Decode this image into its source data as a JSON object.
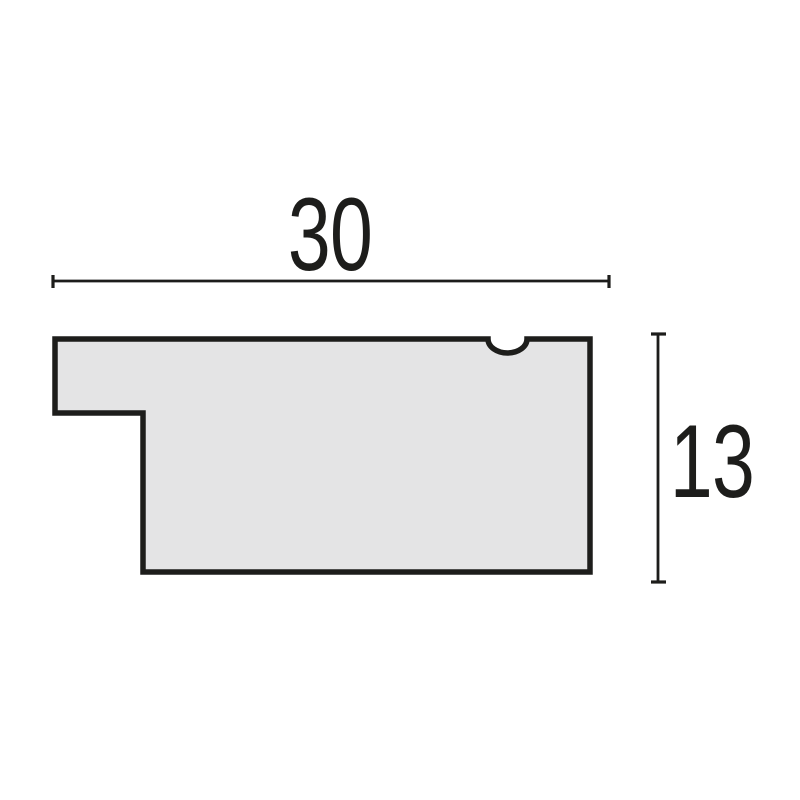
{
  "figure": {
    "title": "moulding-profile-cross-section",
    "width_dimension": {
      "label": "30",
      "value": 30
    },
    "height_dimension": {
      "label": "13",
      "value": 13
    },
    "colors": {
      "fill": "#e4e4e5",
      "outline": "#1d1d1b",
      "dimension": "#1d1d1b",
      "text": "#1d1d1b",
      "background": "#ffffff"
    }
  }
}
